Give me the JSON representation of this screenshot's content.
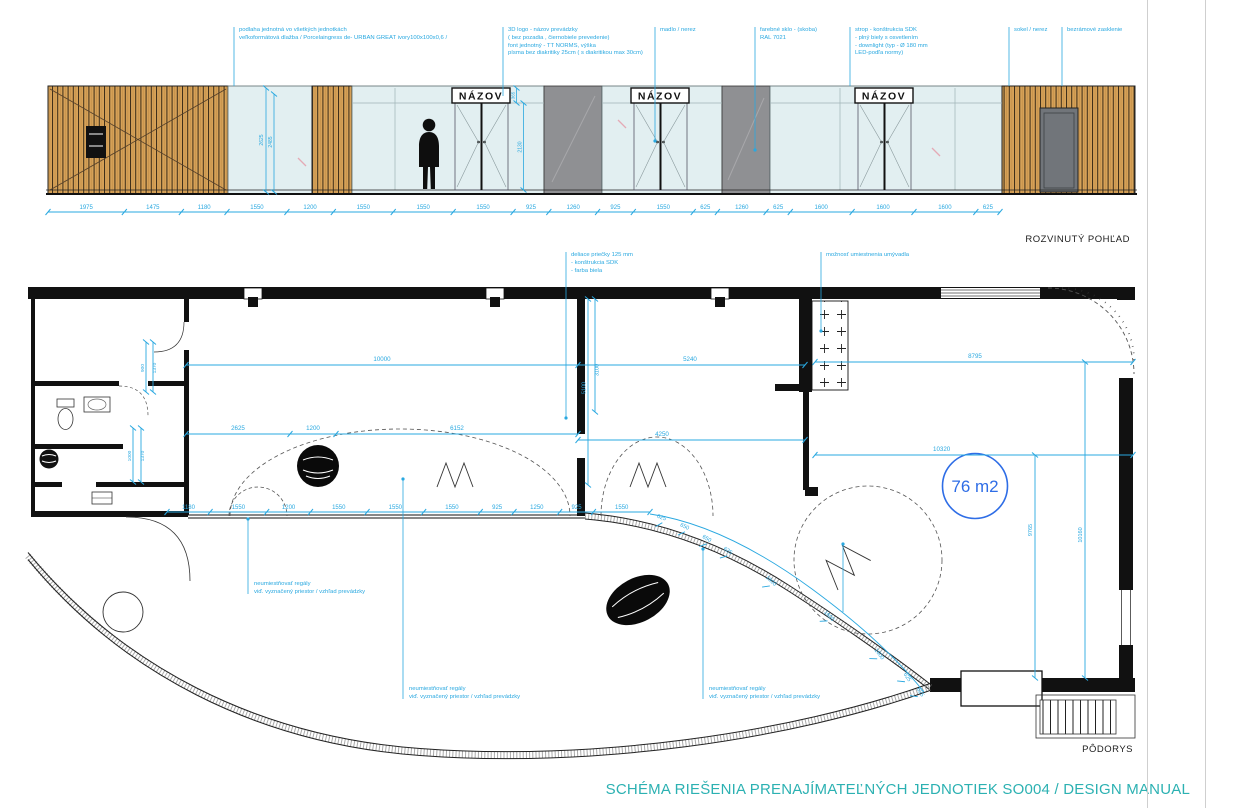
{
  "colors": {
    "cyan": "#29a8e0",
    "blue": "#2e6de6",
    "teal": "#2cb1b2",
    "wood": "#d7a258",
    "glass": "#e2eff1",
    "panel_gray": "#8f9093",
    "ink": "#1b1b1b"
  },
  "labels": {
    "elevation": "ROZVINUTÝ POHĽAD",
    "plan": "PÔDORYS"
  },
  "footer": {
    "title": "SCHÉMA RIEŠENIA PRENAJÍMATEĽNÝCH JEDNOTIEK SO004 / DESIGN MANUAL"
  },
  "elevation": {
    "sign_label": "NÁZOV",
    "dim_chain": [
      1975,
      1475,
      1180,
      1550,
      1200,
      1550,
      1550,
      1550,
      925,
      1260,
      925,
      1550,
      625,
      1260,
      625,
      1600,
      1600,
      1600,
      625
    ],
    "vdims": {
      "a": "2625",
      "b": "2485",
      "c": "365",
      "d": "2130"
    },
    "annotations": [
      {
        "lines": [
          "podlaha jednotná vo všetkých jednotkách",
          "veľkoformátová dlažba / Porcelaingress de- URBAN GREAT ivory100x100x0,6 /"
        ]
      },
      {
        "lines": [
          "3D logo - názov prevádzky",
          "( bez pozadia , čiernobiele prevedenie)",
          "font jednotný - TT NORMS, výška",
          "písma bez diakritiky 25cm ( s diakritikou max 30cm)"
        ]
      },
      {
        "lines": [
          "madlo / nerez"
        ]
      },
      {
        "lines": [
          "farebné sklo - (skoba)",
          "RAL 7021"
        ]
      },
      {
        "lines": [
          "strop - konštrukcia SDK",
          "- plný biely s osvetlením",
          "- downlight (typ - Ø 180 mm",
          "LED-podľa normy)"
        ]
      },
      {
        "lines": [
          "sokel / nerez"
        ]
      },
      {
        "lines": [
          "bezrámové zasklenie"
        ]
      }
    ]
  },
  "plan": {
    "area_label": "76 m2",
    "dim_chain": [
      1180,
      1550,
      1200,
      1550,
      1550,
      1550,
      925,
      1250,
      925,
      1550
    ],
    "curved_dims": [
      {
        "v": "625",
        "x": 661,
        "y": 519,
        "r": 20
      },
      {
        "v": "650",
        "x": 684,
        "y": 528,
        "r": 25
      },
      {
        "v": "650",
        "x": 706,
        "y": 540,
        "r": 30
      },
      {
        "v": "625",
        "x": 727,
        "y": 552,
        "r": 34
      },
      {
        "v": "1600",
        "x": 770,
        "y": 582,
        "r": 42
      },
      {
        "v": "1600",
        "x": 828,
        "y": 617,
        "r": 47
      },
      {
        "v": "1600",
        "x": 878,
        "y": 655,
        "r": 52
      },
      {
        "v": "625",
        "x": 906,
        "y": 678,
        "r": 56
      },
      {
        "v": "625",
        "x": 919,
        "y": 693,
        "r": 58
      }
    ],
    "dims": {
      "d10000": "10000",
      "d5240": "5240",
      "d8795": "8795",
      "d2625": "2625",
      "d1200": "1200",
      "d6152": "6152",
      "d4250": "4250",
      "d10320": "10320",
      "v5100": "5100",
      "v3100": "3100",
      "v900": "900",
      "v1370a": "1370",
      "v1000": "1000",
      "v1370b": "1370",
      "v9765": "9765",
      "v10160": "10160"
    },
    "annotations": [
      {
        "lines": [
          "deliace priečky 125 mm",
          "- konštrukcia SDK",
          "- farba biela"
        ]
      },
      {
        "lines": [
          "možnosť umiestnenia umývadla"
        ]
      },
      {
        "lines": [
          "neumiestňovať regály",
          "viď. vyznačený priestor / vzhľad prevádzky"
        ]
      },
      {
        "lines": [
          "neumiestňovať regály",
          "viď. vyznačený priestor / vzhľad prevádzky"
        ]
      },
      {
        "lines": [
          "neumiestňovať regály",
          "viď. vyznačený priestor / vzhľad prevádzky"
        ]
      }
    ]
  }
}
